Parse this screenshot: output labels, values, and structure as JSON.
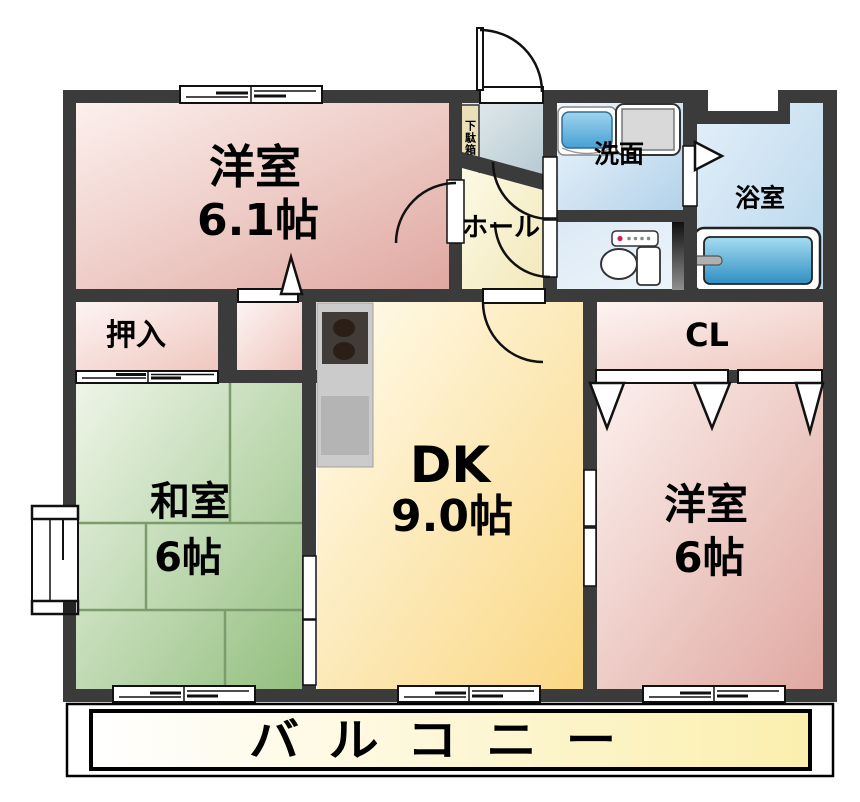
{
  "title": "2DK apartment floor plan",
  "rooms": {
    "western_room_1": {
      "label": "洋室",
      "size": "6.1帖"
    },
    "japanese_room": {
      "label": "和室",
      "size": "6帖"
    },
    "dining_kitchen": {
      "label": "DK",
      "size": "9.0帖"
    },
    "western_room_2": {
      "label": "洋室",
      "size": "6帖"
    },
    "oshiire_closet": {
      "label": "押入"
    },
    "cl_closet": {
      "label": "CL"
    },
    "washroom": {
      "label": "洗面"
    },
    "bathroom": {
      "label": "浴室"
    },
    "hall": {
      "label": "ホール"
    },
    "shoe_cabinet": {
      "label": "下駄箱"
    },
    "balcony": {
      "label": "バルコニー"
    }
  },
  "colors": {
    "wall": "#3b3b3b",
    "western_room_pink": "#e0a8a1",
    "japanese_room_green": "#94bf80",
    "dining_kitchen_yellow": "#fad784",
    "wet_area_blue": "#b3d2ea",
    "balcony_yellow": "#fbefad",
    "tatami_line": "#7d9c6d",
    "tub_blue": "#2f8fc2"
  }
}
